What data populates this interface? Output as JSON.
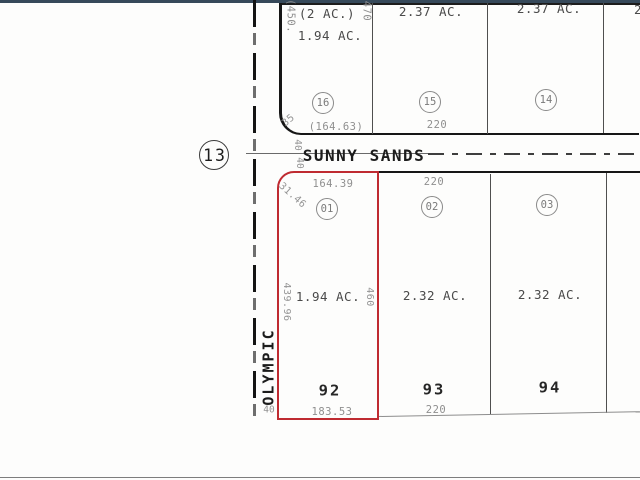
{
  "window": {
    "top_bar_color": "#36495a",
    "bottom_rule_color": "#7d7d7d"
  },
  "map": {
    "section_circle": "13",
    "streets": {
      "sunny_sands": "SUNNY SANDS",
      "olympic": "OLYMPIC"
    },
    "highlight_color": "#bf2b31",
    "north_block": {
      "lots": [
        {
          "id": "16",
          "gross_area": "(2 AC.)",
          "net_area": "1.94 AC.",
          "frontage": "(164.63)",
          "west_dim": "(450.",
          "east_dim": "470",
          "curve_dim": "35"
        },
        {
          "id": "15",
          "area": "2.37 AC.",
          "frontage": "220"
        },
        {
          "id": "14",
          "area": "2.37 AC."
        }
      ],
      "clipped_area_label": "2."
    },
    "south_block": {
      "lots": [
        {
          "id": "01",
          "parcel_no": "92",
          "area": "1.94 AC.",
          "front_dim": "164.39",
          "rear_dim": "183.53",
          "west_dim": "439.96",
          "east_dim": "460",
          "curve_dim": "31.46"
        },
        {
          "id": "02",
          "parcel_no": "93",
          "area": "2.32 AC.",
          "front_dim": "220",
          "rear_dim": "220"
        },
        {
          "id": "03",
          "parcel_no": "94",
          "area": "2.32 AC."
        }
      ]
    },
    "road_widths": {
      "sunny_sands_north": "40",
      "sunny_sands_south": "40",
      "olympic": "40"
    }
  }
}
